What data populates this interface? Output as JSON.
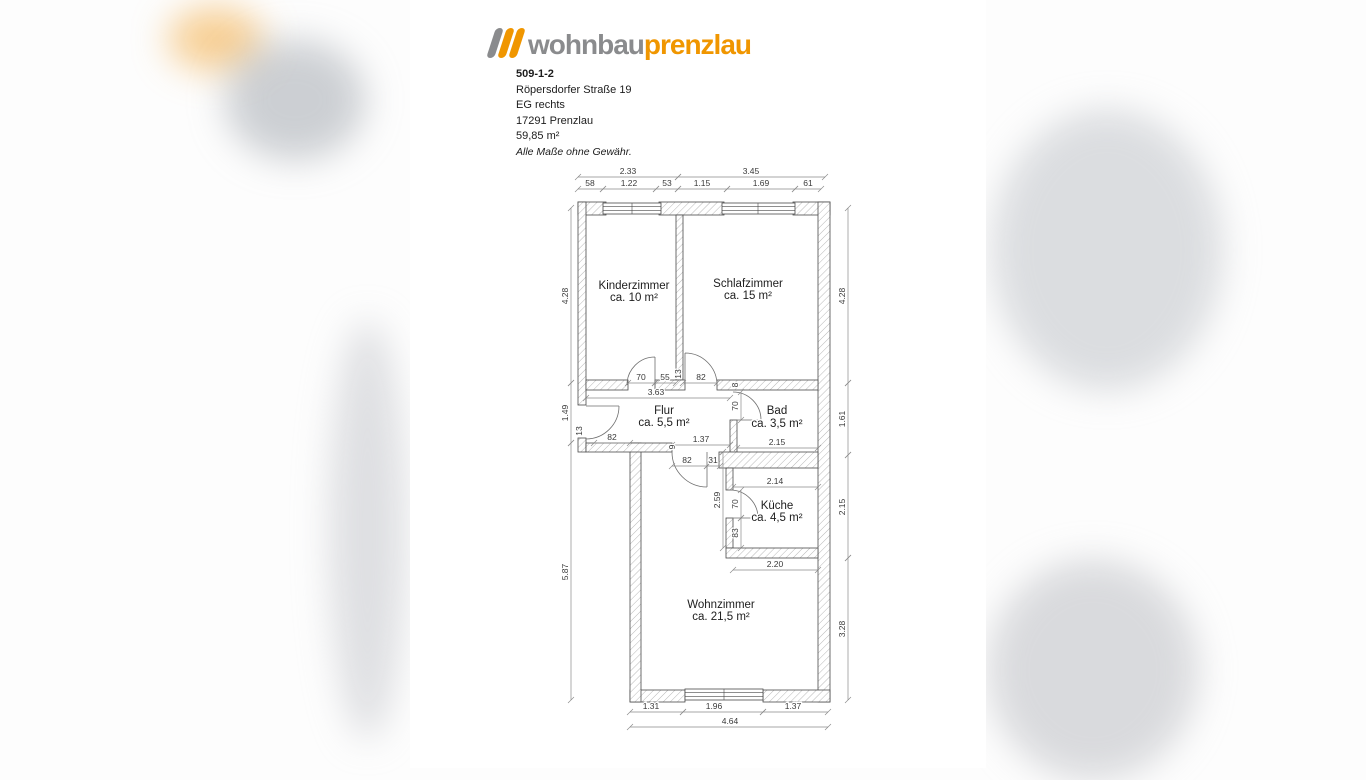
{
  "logo": {
    "brand_gray": "wohnbau",
    "brand_orange": "prenzlau",
    "colors": {
      "orange": "#f09600",
      "gray": "#8a8b8d"
    }
  },
  "header": {
    "object_id": "509-1-2",
    "street": "Röpersdorfer Straße 19",
    "floor": "EG rechts",
    "city": "17291 Prenzlau",
    "area": "59,85 m²",
    "disclaimer": "Alle Maße ohne Gewähr."
  },
  "floorplan": {
    "rooms": [
      {
        "name": "Kinderzimmer",
        "area": "ca. 10 m²"
      },
      {
        "name": "Schlafzimmer",
        "area": "ca. 15 m²"
      },
      {
        "name": "Flur",
        "area": "ca. 5,5 m²"
      },
      {
        "name": "Bad",
        "area": "ca. 3,5 m²"
      },
      {
        "name": "Küche",
        "area": "ca. 4,5 m²"
      },
      {
        "name": "Wohnzimmer",
        "area": "ca. 21,5 m²"
      }
    ],
    "dims": {
      "top1": [
        "2.33",
        "3.45"
      ],
      "top2": [
        "58",
        "1.22",
        "53",
        "1.15",
        "1.69",
        "61"
      ],
      "left": [
        "4.28",
        "1.49",
        "5.87"
      ],
      "right": [
        "4.28",
        "1.61",
        "2.15",
        "3.28"
      ],
      "bottom": [
        "1.31",
        "1.96",
        "1.37"
      ],
      "bottom_total": "4.64",
      "interior": {
        "kz_door": "70",
        "mid_seg": "55",
        "partition": "13",
        "sz_door": "82",
        "flur_width": "3.63",
        "entrance_wall": "13",
        "entrance_door": "82",
        "flur_bad": "1.37",
        "bad_door": "70",
        "bad_wall": "8",
        "bad_width": "2.15",
        "step": "9",
        "wz_door": "82",
        "wz_seg": "31",
        "kueche_top": "2.14",
        "kueche_left": "2.59",
        "kueche_door": "70",
        "kueche_wall": "83",
        "kueche_bottom": "2.20"
      }
    }
  }
}
